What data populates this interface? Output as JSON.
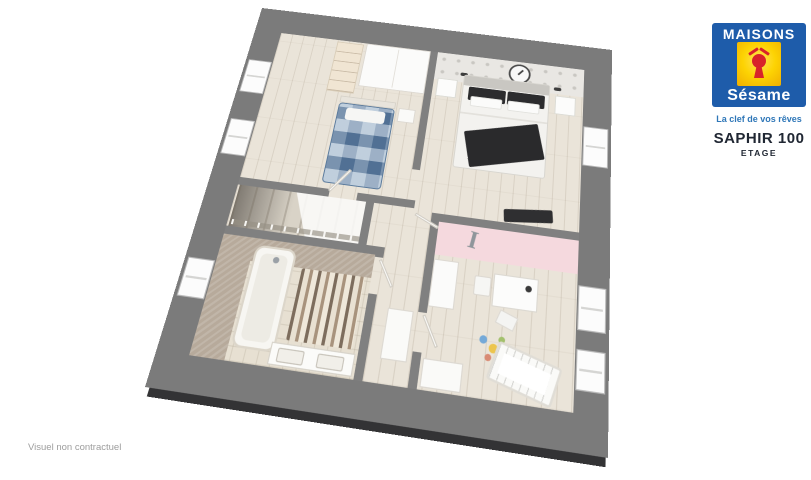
{
  "logo": {
    "line1": "MAISONS",
    "line2": "Sésame",
    "tagline": "La clef de vos rêves",
    "keyhole_icon": "keyhole-with-roof-icon"
  },
  "plan": {
    "title": "SAPHIR 100",
    "subtitle": "ETAGE"
  },
  "footer": {
    "disclaimer": "Visuel non contractuel"
  },
  "floorplan": {
    "wall_letter": "I"
  },
  "colors": {
    "brand_blue": "#1e5caa",
    "brand_yellow": "#fdd303",
    "brand_red": "#d8232a",
    "tagline_blue": "#2f77b8",
    "title_text": "#202733",
    "outer_wall_gray": "#7b7b7b",
    "interior_wall_gray": "#808080",
    "floor_wood": "#eae4d9",
    "accent_pink": "#f5d9de",
    "bathroom_taupe": "#b7aa9b",
    "bed_blue": "#6f8fb0",
    "disclaimer_gray": "#9d9d9d"
  }
}
